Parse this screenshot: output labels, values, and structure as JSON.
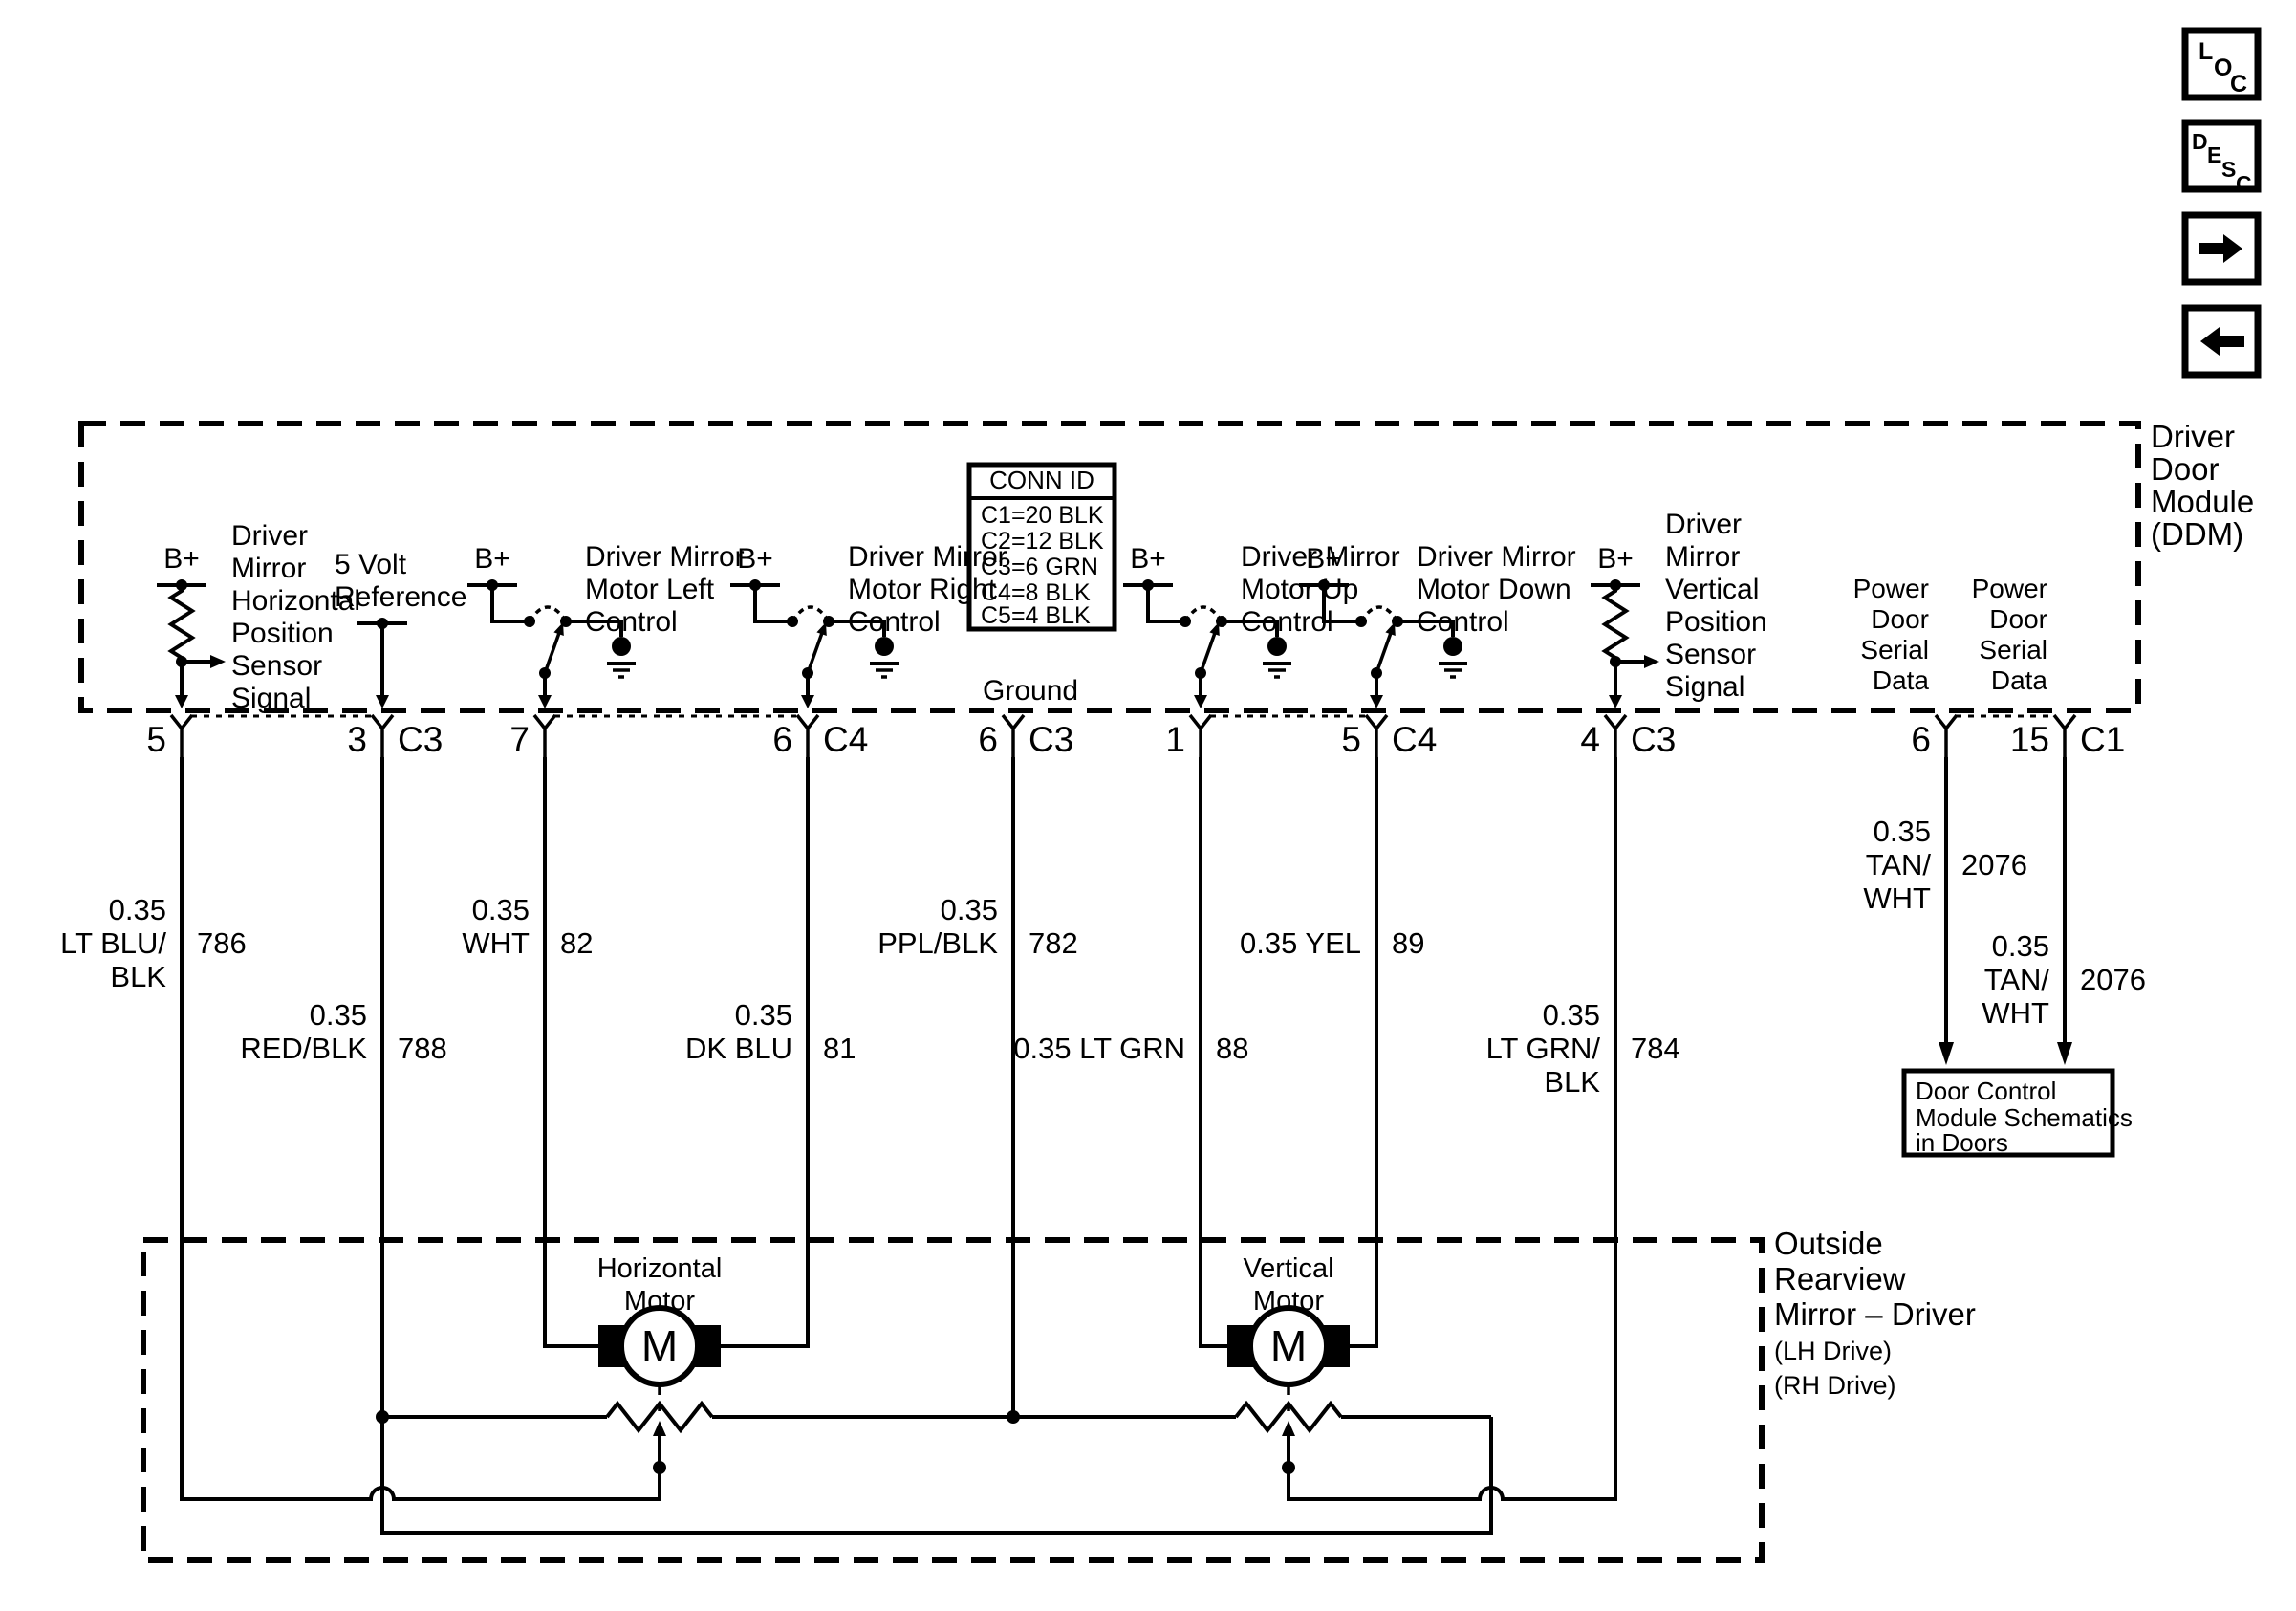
{
  "icons": {
    "loc": [
      "L",
      "O",
      "C"
    ],
    "desc": [
      "D",
      "E",
      "S",
      "C"
    ]
  },
  "conn_id": {
    "title": "CONN ID",
    "rows": [
      "C1=20 BLK",
      "C2=12 BLK",
      "C3=6 GRN",
      "C4=8 BLK",
      "C5=4 BLK"
    ]
  },
  "ddm": {
    "name": [
      "Driver",
      "Door",
      "Module",
      "(DDM)"
    ]
  },
  "mirror": {
    "name": [
      "Outside",
      "Rearview",
      "Mirror – Driver"
    ],
    "sub": [
      "(LH Drive)",
      "(RH Drive)"
    ]
  },
  "components": {
    "h_sensor": {
      "supply": "B+",
      "lines": [
        "Driver",
        "Mirror",
        "Horizontal",
        "Position",
        "Sensor",
        "Signal"
      ]
    },
    "v_ref": {
      "lines": [
        "5 Volt",
        "Reference"
      ]
    },
    "left_ctl": {
      "supply": "B+",
      "lines": [
        "Driver Mirror",
        "Motor Left",
        "Control"
      ]
    },
    "right_ctl": {
      "supply": "B+",
      "lines": [
        "Driver Mirror",
        "Motor Right",
        "Control"
      ]
    },
    "ground": {
      "label": "Ground"
    },
    "up_ctl": {
      "supply": "B+",
      "lines": [
        "Driver Mirror",
        "Motor Up",
        "Control"
      ]
    },
    "down_ctl": {
      "supply": "B+",
      "lines": [
        "Driver Mirror",
        "Motor Down",
        "Control"
      ]
    },
    "v_sensor": {
      "supply": "B+",
      "lines": [
        "Driver",
        "Mirror",
        "Vertical",
        "Position",
        "Sensor",
        "Signal"
      ]
    },
    "serial_a": {
      "lines": [
        "Power",
        "Door",
        "Serial",
        "Data"
      ]
    },
    "serial_b": {
      "lines": [
        "Power",
        "Door",
        "Serial",
        "Data"
      ]
    },
    "h_motor": {
      "symbol": "M",
      "lines": [
        "Horizontal",
        "Motor"
      ]
    },
    "v_motor": {
      "symbol": "M",
      "lines": [
        "Vertical",
        "Motor"
      ]
    },
    "door_box": {
      "lines": [
        "Door Control",
        "Module Schematics",
        "in Doors"
      ]
    }
  },
  "wires": [
    {
      "circuit": "786",
      "color_lines": [
        "0.35",
        "LT BLU/",
        "BLK"
      ],
      "pin": "5",
      "conn": ""
    },
    {
      "circuit": "788",
      "color_lines": [
        "0.35",
        "RED/BLK"
      ],
      "pin": "3",
      "conn": "C3"
    },
    {
      "circuit": "82",
      "color_lines": [
        "0.35",
        "WHT"
      ],
      "pin": "7",
      "conn": ""
    },
    {
      "circuit": "81",
      "color_lines": [
        "0.35",
        "DK BLU"
      ],
      "pin": "6",
      "conn": "C4"
    },
    {
      "circuit": "782",
      "color_lines": [
        "0.35",
        "PPL/BLK"
      ],
      "pin": "6",
      "conn": "C3"
    },
    {
      "circuit": "88",
      "color_lines": [
        "0.35 LT GRN"
      ],
      "pin": "1",
      "conn": ""
    },
    {
      "circuit": "89",
      "color_lines": [
        "0.35 YEL"
      ],
      "pin": "5",
      "conn": "C4"
    },
    {
      "circuit": "784",
      "color_lines": [
        "0.35",
        "LT GRN/",
        "BLK"
      ],
      "pin": "4",
      "conn": "C3"
    },
    {
      "circuit": "2076",
      "color_lines": [
        "0.35",
        "TAN/",
        "WHT"
      ],
      "pin": "6",
      "conn": ""
    },
    {
      "circuit": "2076",
      "color_lines": [
        "0.35",
        "TAN/",
        "WHT"
      ],
      "pin": "15",
      "conn": "C1"
    }
  ]
}
